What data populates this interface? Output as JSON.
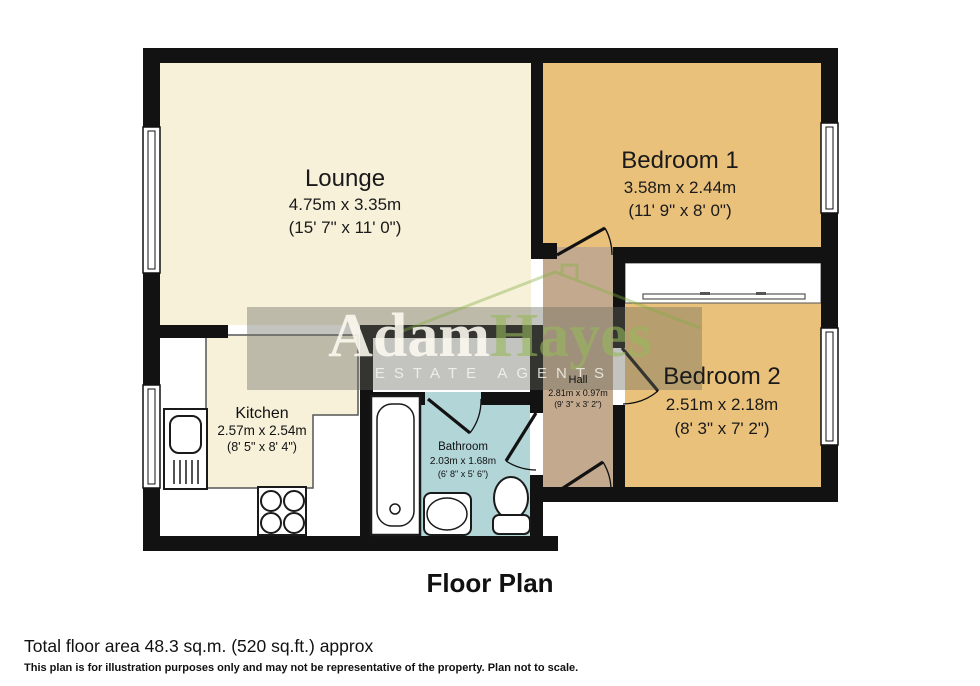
{
  "title": "Floor Plan",
  "rooms": {
    "lounge": {
      "name": "Lounge",
      "metric": "4.75m x 3.35m",
      "imperial": "(15' 7\" x 11' 0\")"
    },
    "bedroom1": {
      "name": "Bedroom 1",
      "metric": "3.58m x 2.44m",
      "imperial": "(11' 9\" x 8' 0\")"
    },
    "bedroom2": {
      "name": "Bedroom 2",
      "metric": "2.51m x 2.18m",
      "imperial": "(8' 3\" x 7' 2\")"
    },
    "kitchen": {
      "name": "Kitchen",
      "metric": "2.57m x 2.54m",
      "imperial": "(8' 5\" x 8' 4\")"
    },
    "bathroom": {
      "name": "Bathroom",
      "metric": "2.03m x 1.68m",
      "imperial": "(6' 8\" x 5' 6\")"
    },
    "hall": {
      "name": "Hall",
      "metric": "2.81m x 0.97m",
      "imperial": "(9' 3\" x 3' 2\")"
    }
  },
  "watermark": {
    "word1": "Adam",
    "word2": "Hayes",
    "tagline": "ESTATE AGENTS"
  },
  "footer": {
    "total_area": "Total floor area 48.3 sq.m. (520 sq.ft.) approx",
    "disclaimer": "This plan is for illustration purposes only and may not be representative of the property. Plan not to scale."
  },
  "colors": {
    "wall": "#121212",
    "lounge_floor": "#f7f1da",
    "bedroom_floor": "#e9c17b",
    "hall_floor": "#c3aa8e",
    "bathroom_floor": "#b2d5d8",
    "watermark_green": "#9cbf6e"
  }
}
